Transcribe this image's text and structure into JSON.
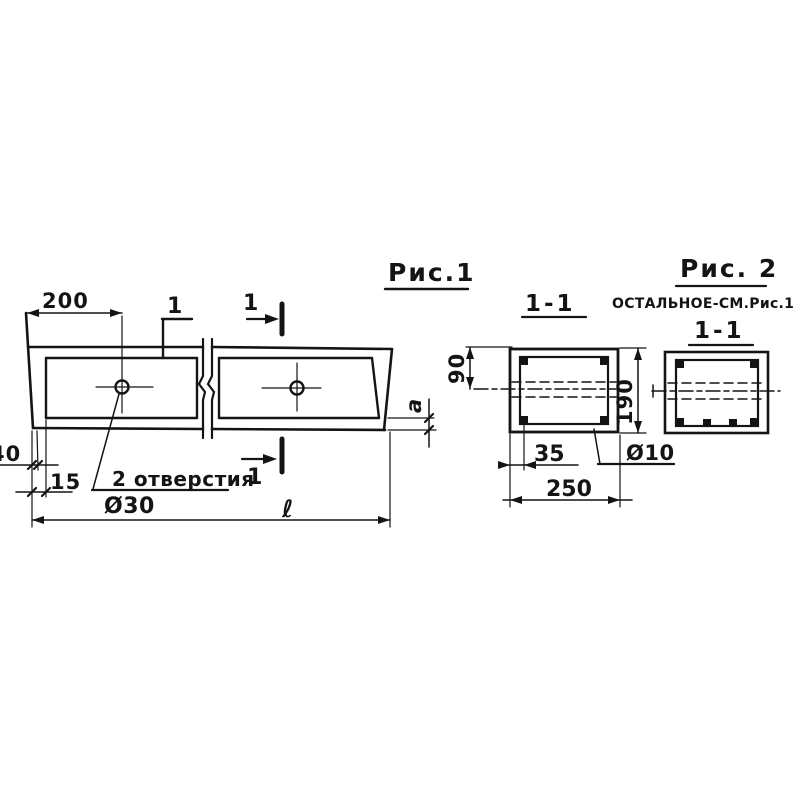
{
  "sheet": {
    "background": "#ffffff",
    "ink_color": "#141414"
  },
  "fig1": {
    "title": "Рис.1",
    "cut_mark_digit": "1",
    "dim_200": "200",
    "dim_40": "40",
    "dim_15": "15",
    "dim_a": "a",
    "dim_length": "ℓ",
    "holes_note": "2 отверстия",
    "holes_dia": "Ø30"
  },
  "section_1_1": {
    "label": "1-1",
    "dim_90": "90",
    "dim_190": "190",
    "dim_35": "35",
    "dim_250": "250",
    "rebar_dia": "Ø10"
  },
  "fig2": {
    "title": "Рис. 2",
    "note": "ОСТАЛЬНОЕ-СМ.Рис.1",
    "label": "1-1"
  }
}
